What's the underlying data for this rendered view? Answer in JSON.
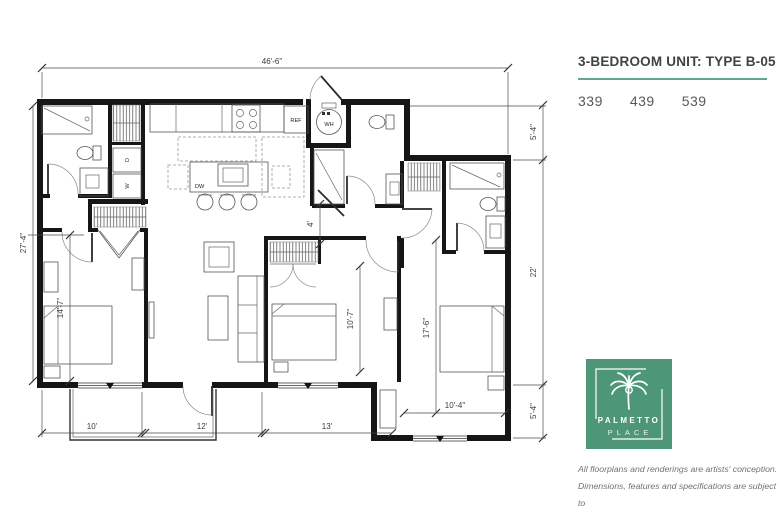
{
  "panel": {
    "title": "3-BEDROOM UNIT: TYPE B-05",
    "unit_numbers": [
      "339",
      "439",
      "539"
    ],
    "logo": {
      "line1": "PALMETTO",
      "line2": "PLACE"
    },
    "disclaimer": [
      "All floorplans and renderings are artists' conception.",
      "Dimensions, features and specifications are subject to",
      "change at the discretion of the builder."
    ],
    "colors": {
      "brand_green": "#4e9678",
      "underline_teal": "#63a695",
      "title_text": "#3d4347",
      "number_text": "#55595e"
    }
  },
  "floorplan": {
    "dimensions": {
      "overall_width": "46'-6\"",
      "left_total": "27'-4\"",
      "left_lower": "14'-7\"",
      "right_top": "5'-4\"",
      "right_middle": "22'",
      "right_bottom": "5'-4\"",
      "bottom_left": "10'",
      "bottom_middle": "12'",
      "bottom_right": "13'",
      "hall_width": "4'",
      "bed2_depth": "10'-7\"",
      "bed3_depth": "17'-6\"",
      "bed3_width": "10'-4\""
    },
    "labels": {
      "refrigerator": "REF",
      "water_heater": "WH",
      "dishwasher": "DW",
      "dryer": "D",
      "washer": "W"
    }
  }
}
